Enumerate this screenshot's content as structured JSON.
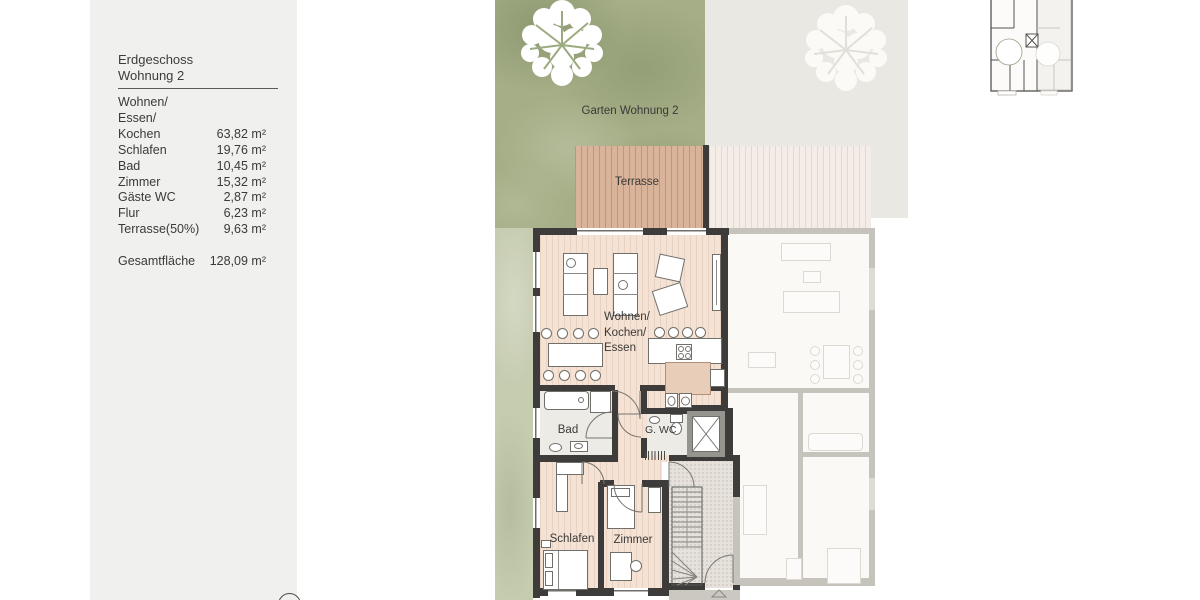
{
  "panel": {
    "title_line1": "Erdgeschoss",
    "title_line2": "Wohnung 2",
    "rows": [
      {
        "label": "Wohnen/",
        "value": ""
      },
      {
        "label": "Essen/",
        "value": ""
      },
      {
        "label": "Kochen",
        "value": "63,82 m²"
      },
      {
        "label": "Schlafen",
        "value": "19,76 m²"
      },
      {
        "label": "Bad",
        "value": "10,45 m²"
      },
      {
        "label": "Zimmer",
        "value": "15,32 m²"
      },
      {
        "label": "Gäste WC",
        "value": "2,87 m²"
      },
      {
        "label": "Flur",
        "value": "6,23 m²"
      },
      {
        "label": "Terrasse(50%)",
        "value": "9,63 m²"
      }
    ],
    "total_label": "Gesamtfläche",
    "total_value": "128,09 m²"
  },
  "plan": {
    "garden_label": "Garten Wohnung 2",
    "terrace_label": "Terrasse",
    "living_lines": [
      "Wohnen/",
      "Kochen/",
      "Essen"
    ],
    "bad_label": "Bad",
    "wc_label": "G. WC",
    "schlafen_label": "Schlafen",
    "zimmer_label": "Zimmer"
  },
  "icons": {
    "tree": "tree-icon",
    "compass": "compass-circle",
    "entrance_marker": "entrance-triangle-icon",
    "elevator": "elevator-x-icon"
  },
  "colors": {
    "panel_bg": "#f0f0ee",
    "garden_green": "#a5ae86",
    "garden_light": "#c6ccb0",
    "terrace_wood": "#dab49a",
    "floor_wood": "#f4e2d5",
    "wall_dark": "#3d3c3a",
    "faded_wall": "#c6c3bd"
  }
}
